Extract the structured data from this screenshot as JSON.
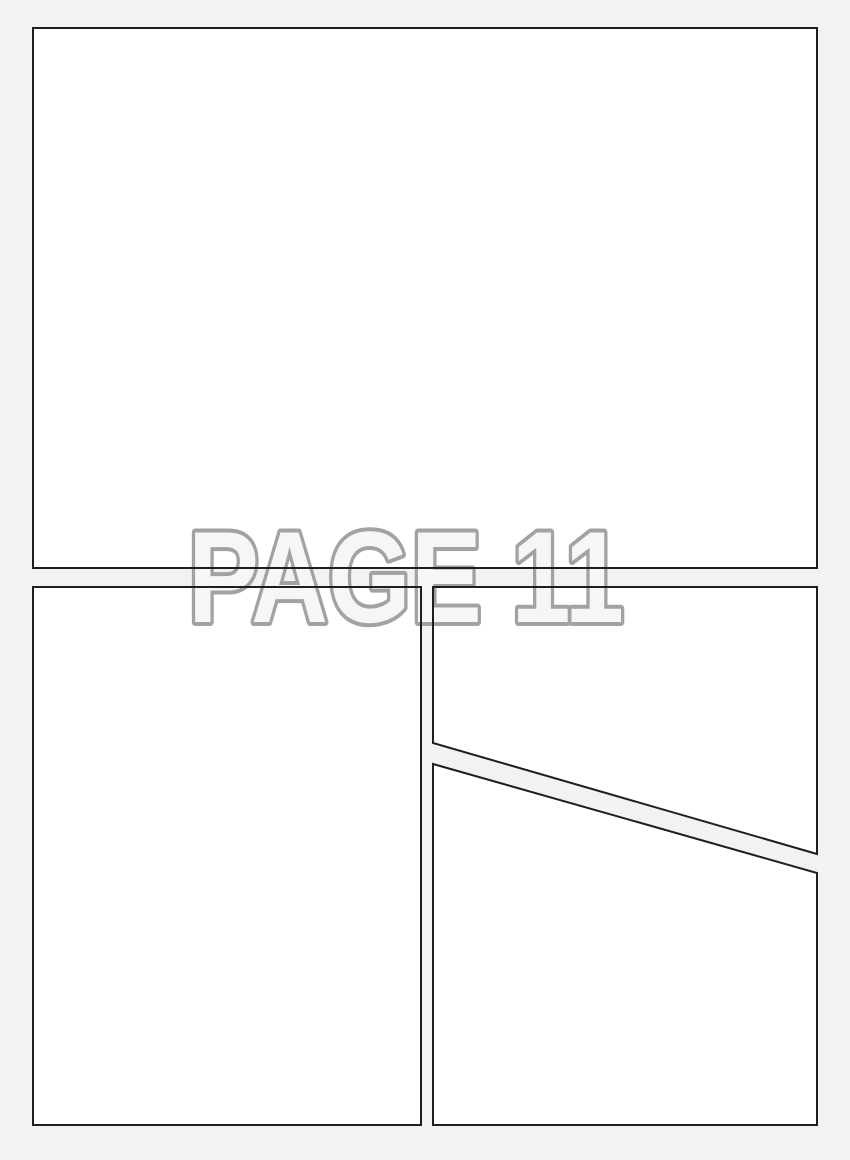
{
  "watermark": {
    "text": "PAGE 11"
  },
  "panels": {
    "count": 4
  },
  "colors": {
    "page_background": "#f2f2f2",
    "panel_fill": "#ffffff",
    "panel_border": "#1e1e1e",
    "watermark_stroke": "#a2a2a2",
    "watermark_fill": "#f6f6f6"
  }
}
